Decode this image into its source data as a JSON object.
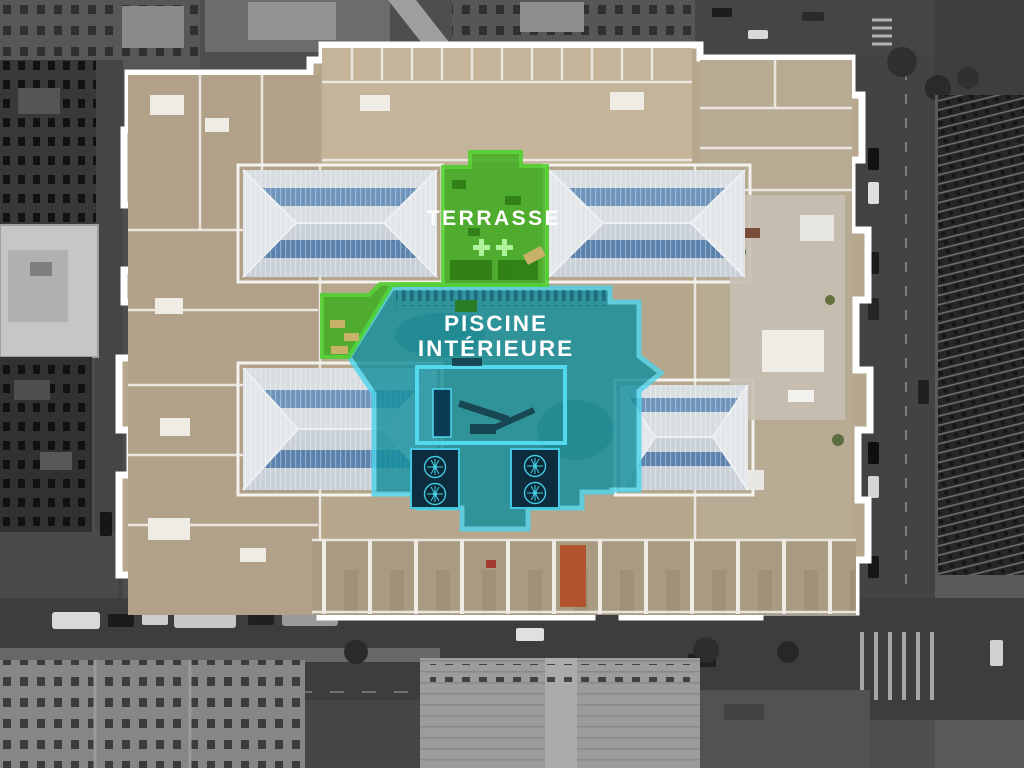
{
  "scene": {
    "description": "Aerial drone photo of a city-block building; surroundings in grayscale, building in color with highlighted amenity zones",
    "building": {
      "outline_color": "#ffffff",
      "roof_color": "#b7a78d"
    },
    "annotations": {
      "terrasse": {
        "label": "TERRASSE",
        "fill_color": "#3fae1e",
        "border_color": "#4bd329",
        "text_color": "#ffffff",
        "markers": [
          "plus-cross",
          "plus-cross"
        ]
      },
      "piscine": {
        "line1": "PISCINE",
        "line2": "INTÉRIEURE",
        "fill_color": "#148f9c",
        "border_color": "#4fd4ec",
        "text_color": "#ffffff"
      }
    }
  }
}
